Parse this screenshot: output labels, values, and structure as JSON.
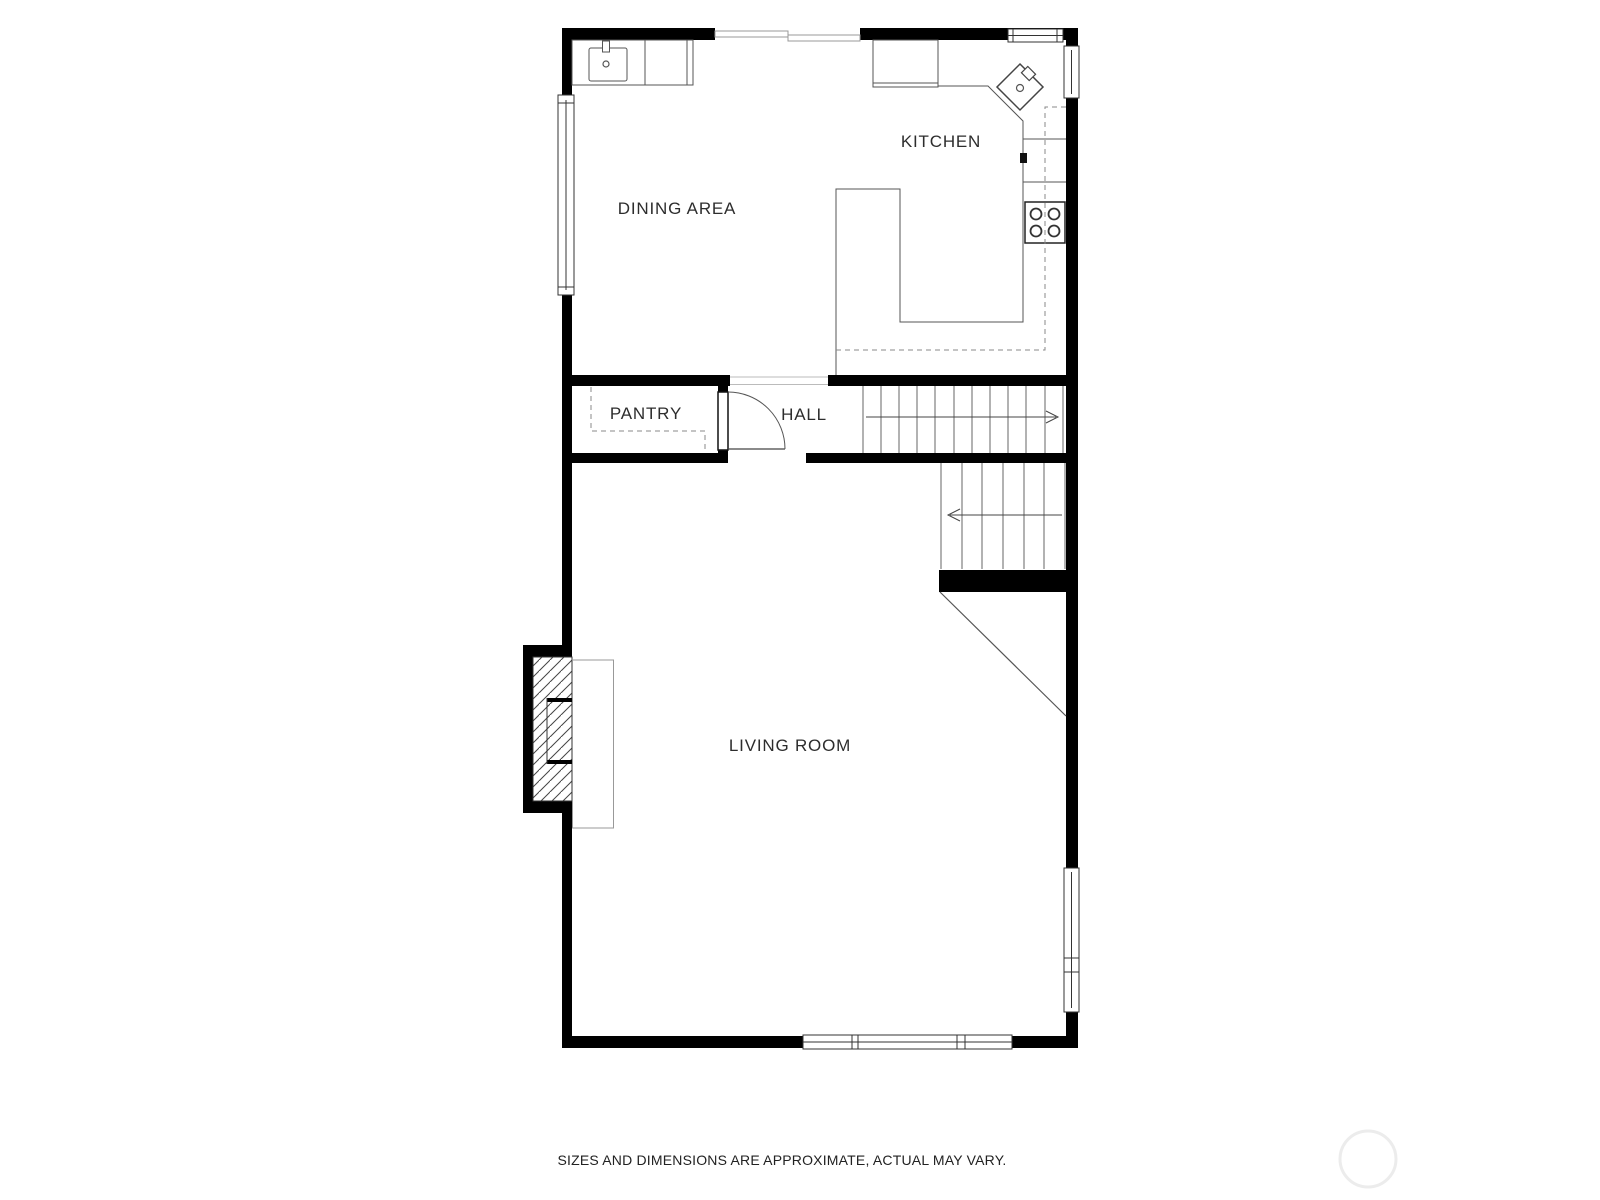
{
  "plan": {
    "rooms": {
      "kitchen": "KITCHEN",
      "dining_area": "DINING AREA",
      "pantry": "PANTRY",
      "hall": "HALL",
      "living_room": "LIVING ROOM"
    },
    "disclaimer": "SIZES AND DIMENSIONS ARE APPROXIMATE, ACTUAL MAY VARY.",
    "stairs": {
      "upper_flight_arrow": "right",
      "lower_flight_arrow": "left"
    },
    "fixtures": [
      "kitchen-sink",
      "corner-sink",
      "stove-4-burner",
      "refrigerator-cabinet",
      "counter-peninsula",
      "pantry-shelves-dashed",
      "fireplace-with-hearth",
      "swing-door"
    ],
    "colors": {
      "wall": "#000000",
      "counter_line": "#555555",
      "dashed_line": "#888888",
      "label_text": "#2d2d2d",
      "watermark": "#ececec",
      "background": "#ffffff"
    }
  }
}
